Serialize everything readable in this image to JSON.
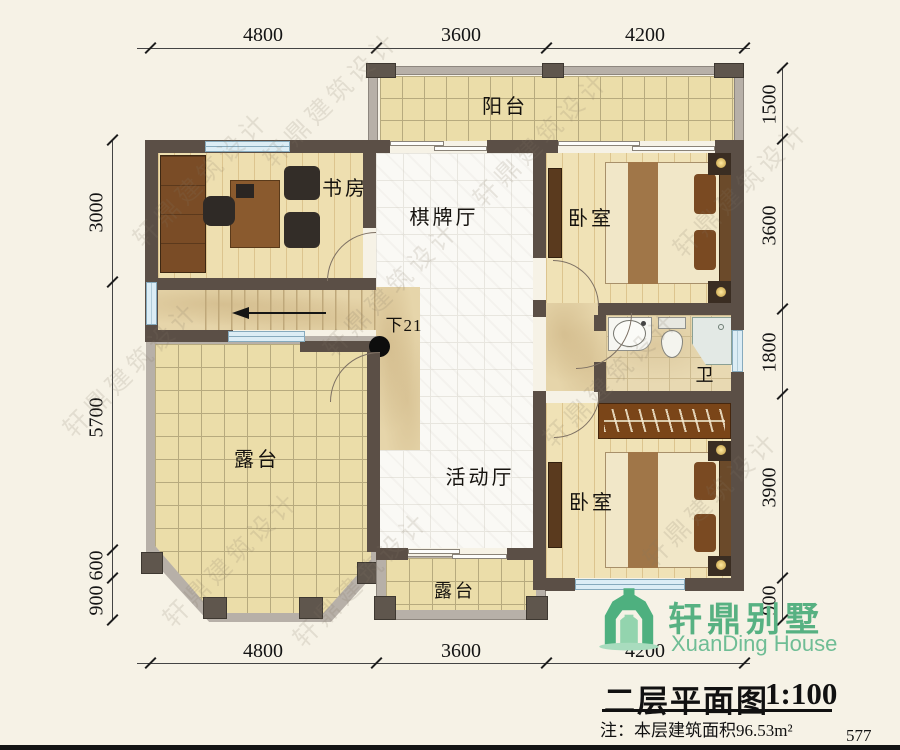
{
  "watermark": "轩鼎建筑设计",
  "rooms": {
    "balcony": "阳台",
    "study": "书房",
    "chess_hall": "棋牌厅",
    "bedroom_top": "卧室",
    "bathroom": "卫",
    "terrace_main": "露台",
    "activity_hall": "活动厅",
    "bedroom_bottom": "卧室",
    "terrace_small": "露台",
    "stairs_note": "下21"
  },
  "dimensions": {
    "top": [
      "4800",
      "3600",
      "4200"
    ],
    "bottom": [
      "4800",
      "3600",
      "4200"
    ],
    "left": [
      "3000",
      "5700",
      "600",
      "900"
    ],
    "right": [
      "1500",
      "3600",
      "1800",
      "3900",
      "900"
    ]
  },
  "title_block": {
    "brand_cn": "轩鼎别墅",
    "brand_en": "XuanDing House",
    "plan_title": "二层平面图",
    "scale": "1:100",
    "note": "注：本层建筑面积96.53m²"
  },
  "page_number": "577",
  "colors": {
    "wall": "#5b4f46",
    "brand_green": "#4eb07f",
    "window": "#dcedf5",
    "floor_cream": "#ebdda9"
  }
}
